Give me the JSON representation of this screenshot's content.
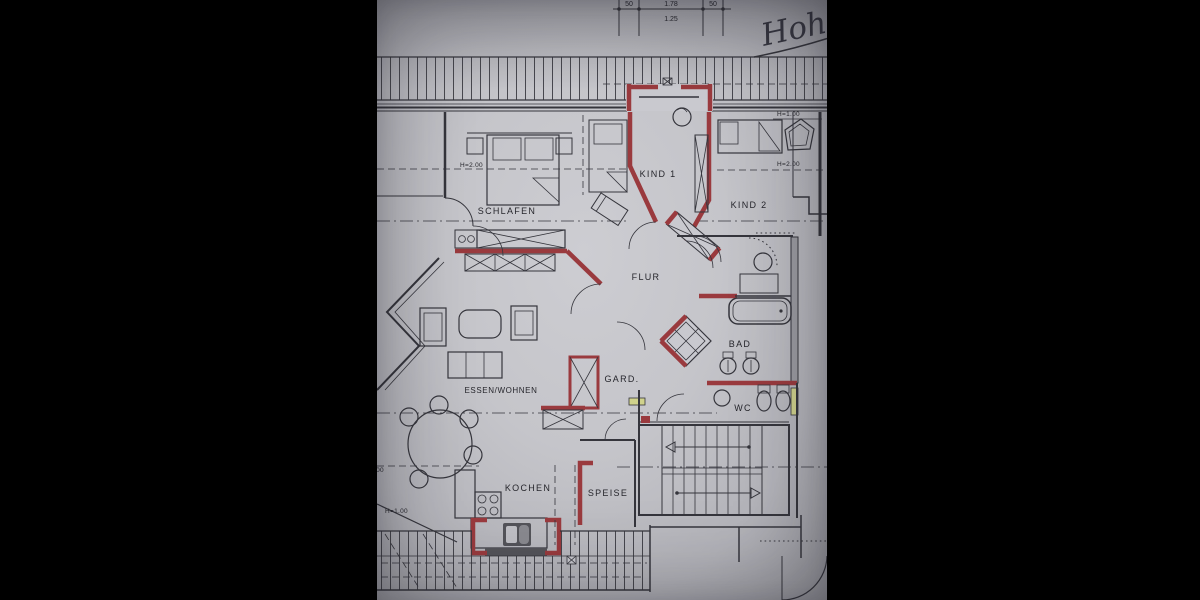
{
  "scene": {
    "type": "photo-of-floor-plan",
    "background": "#000000"
  },
  "plan": {
    "handwritten_note": "Hoh",
    "dimension_chain": {
      "top_left": "50",
      "top_middle": "1.78",
      "top_right": "50",
      "below": "1.25"
    },
    "rooms": {
      "schlafen": "SCHLAFEN",
      "kind1": "KIND 1",
      "kind2": "KIND 2",
      "flur": "FLUR",
      "bad": "BAD",
      "wc": "WC",
      "gard": "GARD.",
      "essen_wohnen": "ESSEN/WOHNEN",
      "kochen": "KOCHEN",
      "speise": "SPEISE"
    },
    "height_marks": {
      "schlafen": "H=2.00",
      "kind2_upper": "H=1.00",
      "kind2_lower": "H=2.00",
      "wohnen_upper": "H=2.00",
      "wohnen_lower": "H=1.00"
    },
    "colors": {
      "paper": "#c6c6cb",
      "ink": "#35353c",
      "wall_red": "#9a3a3e",
      "door_highlight": "#d0d28c"
    }
  }
}
